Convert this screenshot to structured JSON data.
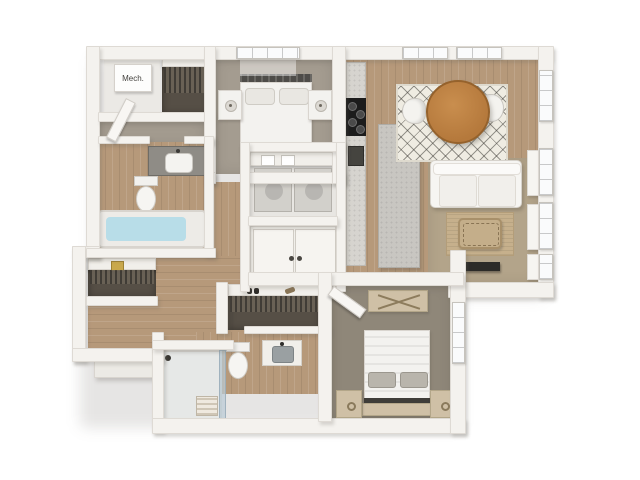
{
  "labels": {
    "mech_closet": "Mech."
  },
  "colors": {
    "bg": "#ffffff",
    "wall": "#f4f2ee",
    "wall_edge": "#dedad4",
    "wood": "#b6997a",
    "carpet_bedroom1": "#a49c90",
    "carpet_bedroom2": "#8f8779",
    "carpet_living": "#b3a48a",
    "closet_dark": "#564f46",
    "rug_dining": "#efece2",
    "rug_jute": "#c6b08c",
    "table_wood": "#b5793c",
    "counter_gray": "#d6d4cf",
    "island_gray": "#c8c6c1",
    "appliance_dark": "#1c1c1c",
    "tub_water": "#b8dde8",
    "shower_tile": "#e6e8e7",
    "sofa_white": "#f6f5f2",
    "bed_white": "#f3f2ef",
    "furn_tan": "#cfc0a6",
    "tv_dark": "#2c2b28",
    "vanity_counter": "#8f8c86"
  }
}
